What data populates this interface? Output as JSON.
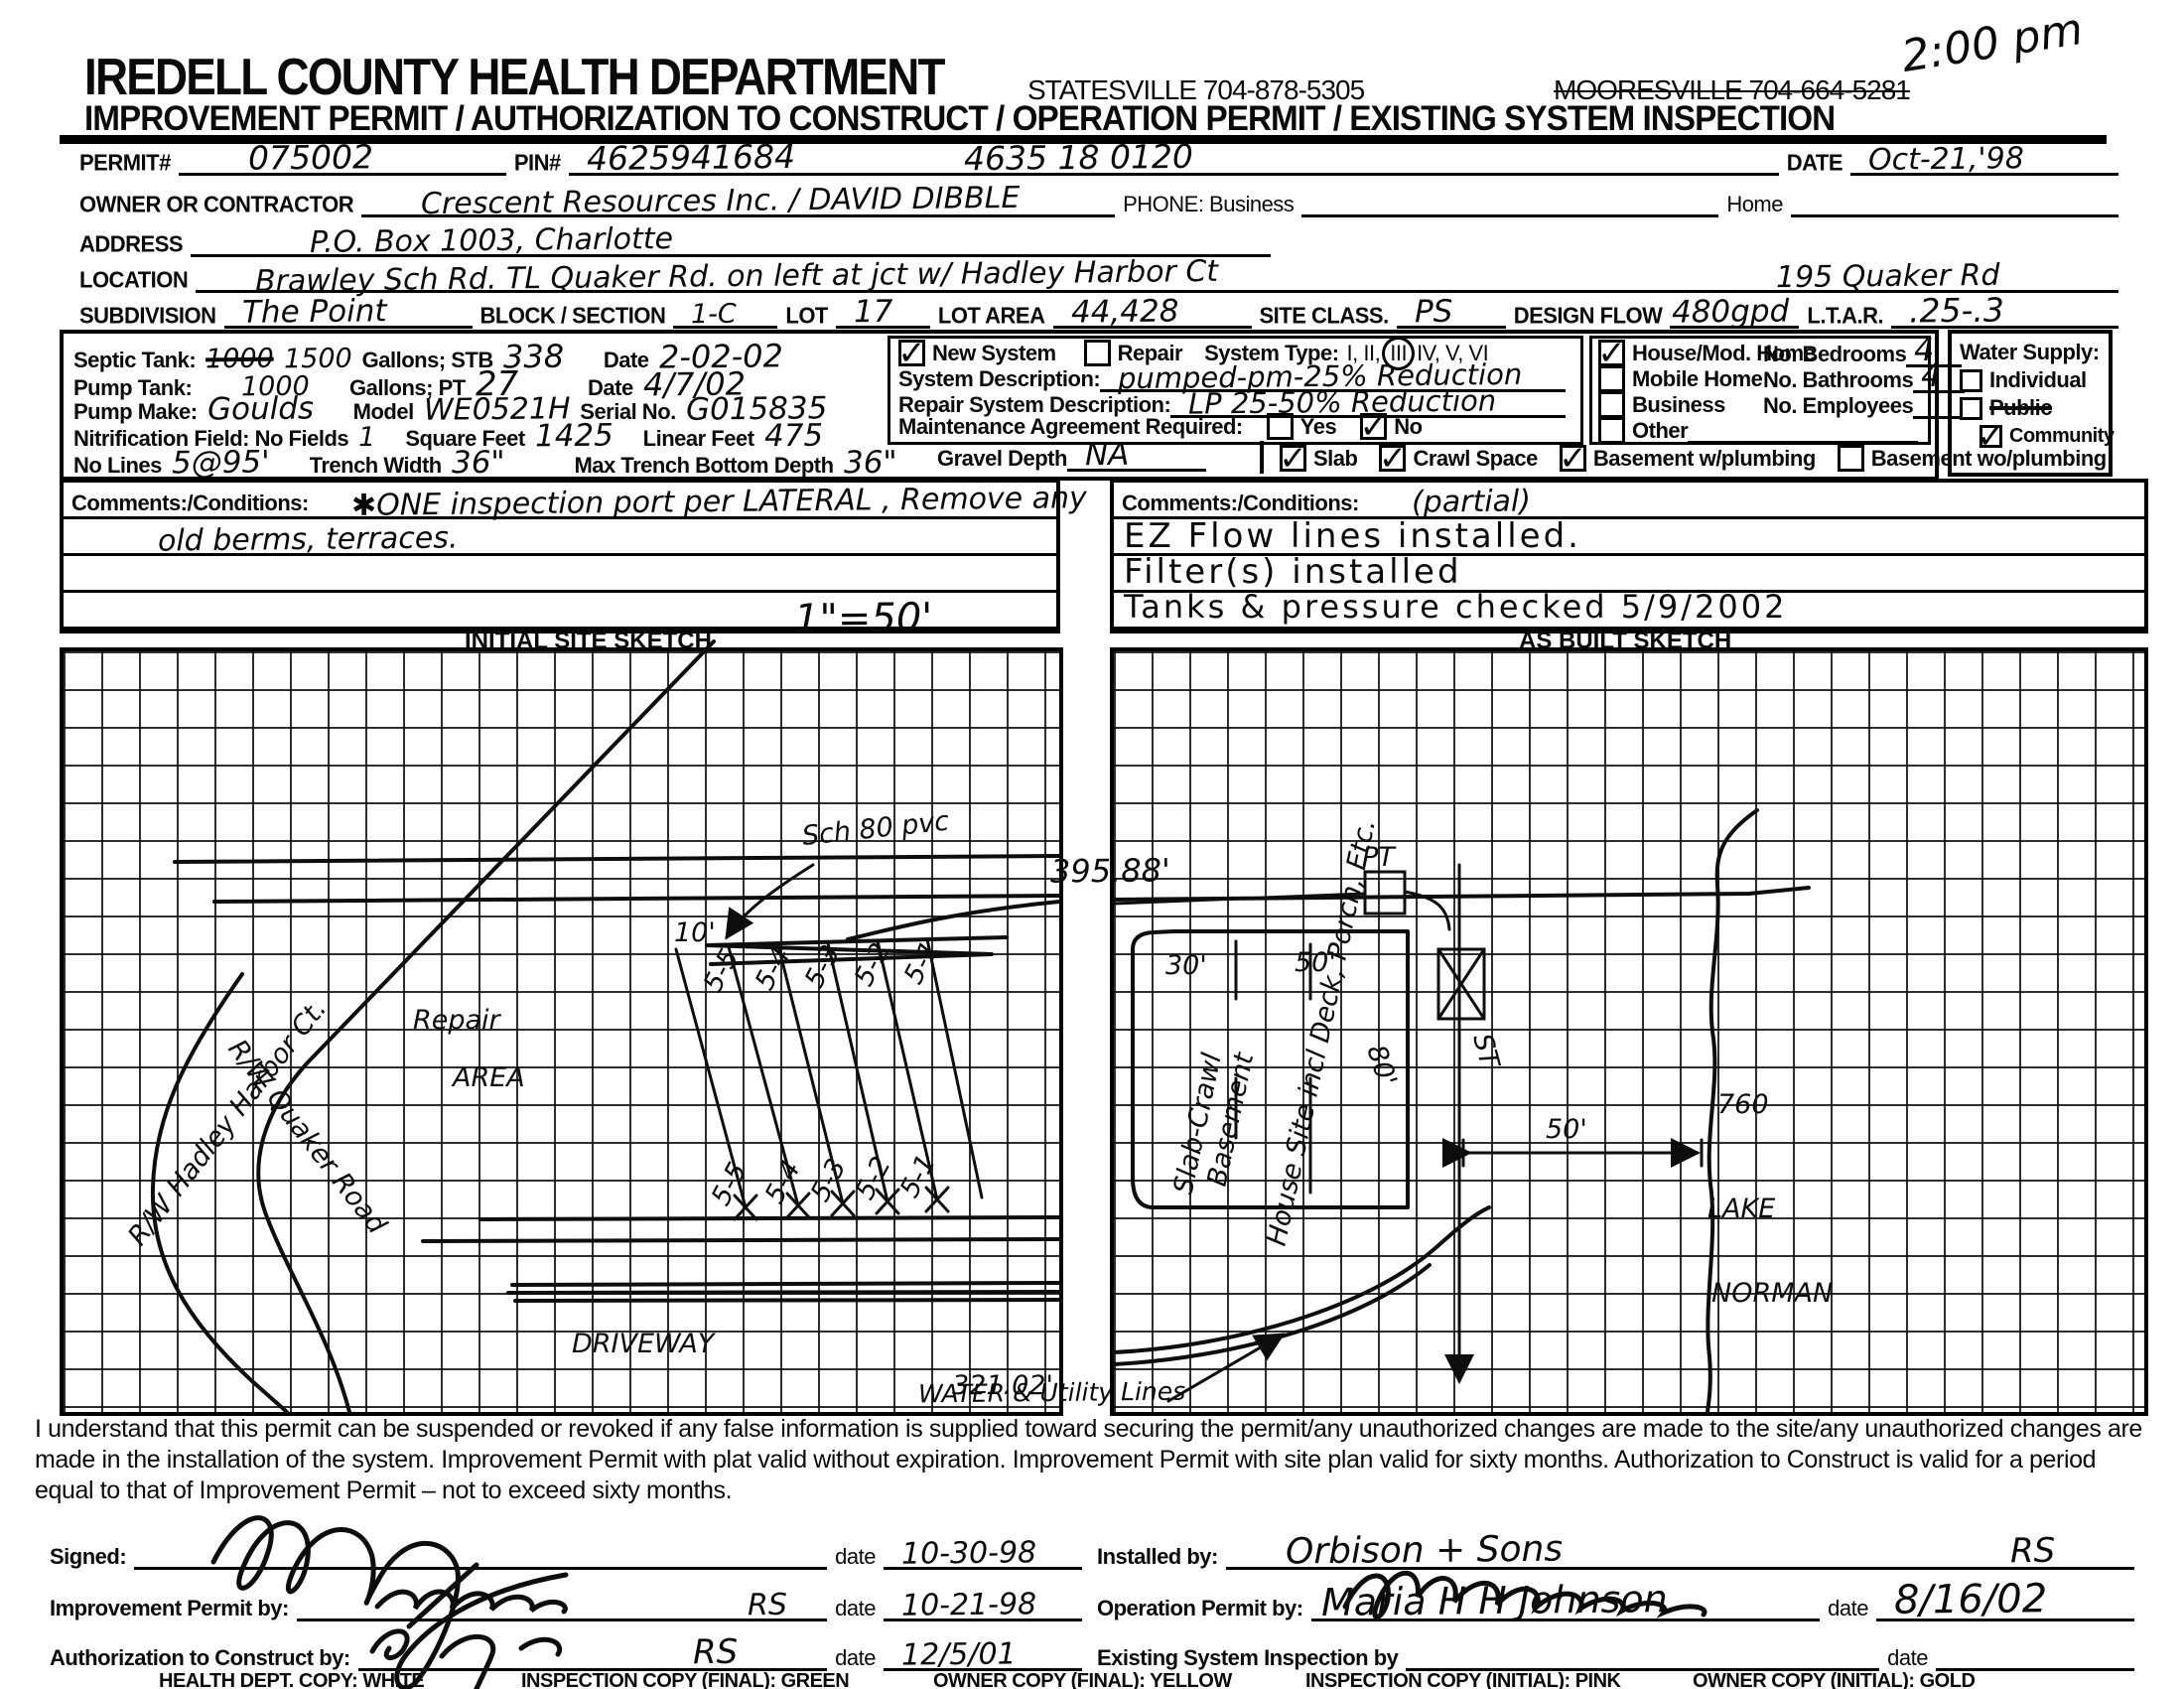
{
  "icons": {
    "check": "✓"
  },
  "header": {
    "department": "IREDELL COUNTY HEALTH DEPARTMENT",
    "statesville": "STATESVILLE 704-878-5305",
    "mooresville": "MOORESVILLE 704-664-5281",
    "time_note": "2:00 pm",
    "subtitle": "IMPROVEMENT PERMIT / AUTHORIZATION TO CONSTRUCT / OPERATION PERMIT / EXISTING SYSTEM INSPECTION"
  },
  "fields": {
    "permit_label": "PERMIT#",
    "permit_value": "075002",
    "pin_label": "PIN#",
    "pin_value": "4625941684",
    "parcel_value": "4635  18  0120",
    "date_label": "DATE",
    "date_value": "Oct-21,'98",
    "owner_label": "OWNER OR CONTRACTOR",
    "owner_value": "Crescent Resources Inc. / DAVID DIBBLE",
    "phone_label": "PHONE: Business",
    "home_label": "Home",
    "address_label": "ADDRESS",
    "address_value": "P.O. Box 1003, Charlotte",
    "location_label": "LOCATION",
    "location_value": "Brawley Sch Rd.   TL Quaker Rd.   on left at jct w/ Hadley Harbor Ct",
    "location_value2": "195 Quaker Rd",
    "subdivision_label": "SUBDIVISION",
    "subdivision_value": "The Point",
    "block_label": "BLOCK / SECTION",
    "block_value": "1-C",
    "lot_label": "LOT",
    "lot_value": "17",
    "lot_area_label": "LOT AREA",
    "lot_area_value": "44,428",
    "site_class_label": "SITE CLASS.",
    "site_class_value": "PS",
    "design_flow_label": "DESIGN FLOW",
    "design_flow_value": "480gpd",
    "ltar_label": "L.T.A.R.",
    "ltar_value": ".25-.3"
  },
  "tank": {
    "septic_label": "Septic Tank:",
    "septic_old": "1000",
    "septic_new": "1500",
    "septic_units": "Gallons;  STB",
    "stb_value": "338",
    "date_label": "Date",
    "stb_date": "2-02-02",
    "pump_label": "Pump Tank:",
    "pump_value": "1000",
    "pump_units": "Gallons;  PT",
    "pt_value": "27",
    "pt_date": "4/7/02",
    "make_label": "Pump Make:",
    "make_value": "Goulds",
    "model_label": "Model",
    "model_value": "WE0521H",
    "serial_label": "Serial No.",
    "serial_value": "G015835",
    "nit_label": "Nitrification Field: No Fields",
    "fields_value": "1",
    "sqft_label": "Square Feet",
    "sqft_value": "1425",
    "linear_label": "Linear Feet",
    "linear_value": "475",
    "lines_label": "No Lines",
    "lines_value": "5@95'",
    "trench_label": "Trench Width",
    "trench_value": "36\"",
    "depth_label": "Max Trench Bottom Depth",
    "depth_value": "36\""
  },
  "system": {
    "new_label": "New System",
    "repair_label": "Repair",
    "type_label": "System Type:",
    "type_pre": "I, II,",
    "type_circled": "III",
    "type_post": "IV, V, VI",
    "new_checked": true,
    "repair_checked": false,
    "desc_label": "System Description:",
    "desc_value": "pumped-pm-25% Reduction",
    "repair_desc_label": "Repair System Description:",
    "repair_desc_value": "LP 25-50% Reduction",
    "maint_label": "Maintenance Agreement Required:",
    "yes_label": "Yes",
    "no_label": "No",
    "yes_checked": false,
    "no_checked": true,
    "gravel_label": "Gravel Depth",
    "gravel_value": "NA",
    "slab_label": "Slab",
    "crawl_label": "Crawl Space",
    "bw_label": "Basement w/plumbing",
    "bwo_label": "Basement wo/plumbing",
    "slab_checked": true,
    "crawl_checked": true,
    "bw_checked": true,
    "bwo_checked": false
  },
  "structure": {
    "house_label": "House/Mod. Home",
    "mobile_label": "Mobile Home",
    "business_label": "Business",
    "other_label": "Other",
    "house_checked": true,
    "mobile_checked": false,
    "business_checked": false,
    "other_checked": false,
    "bedrooms_label": "No. Bedrooms",
    "bedrooms_value": "4",
    "bathrooms_label": "No. Bathrooms",
    "bathrooms_value": "4",
    "employees_label": "No. Employees",
    "employees_value": ""
  },
  "water": {
    "title": "Water Supply:",
    "individual": "Individual",
    "public": "Public",
    "community": "Community",
    "individual_checked": false,
    "public_checked": false,
    "community_checked": true
  },
  "comments_left": {
    "label": "Comments:/Conditions:",
    "line1": "✱ONE inspection port per LATERAL , Remove any",
    "line2": "old berms, terraces."
  },
  "comments_right": {
    "label": "Comments:/Conditions:",
    "note": "(partial)",
    "line1": "EZ Flow lines installed.",
    "line2": "Filter(s) installed",
    "line3": "Tanks & pressure checked 5/9/2002"
  },
  "sketch": {
    "left_title": "INITIAL SITE SKETCH",
    "scale_note": "1\"=50'",
    "right_title": "AS BUILT SKETCH",
    "left": {
      "road1": "R/W Hadley Harbor Ct.",
      "road2": "R/W Quaker Road",
      "repair1": "Repair",
      "repair2": "AREA",
      "pipe": "Sch 80 pvc",
      "ten": "10'",
      "boundary": "395.88'",
      "driveway": "DRIVEWAY",
      "front": "321.02'",
      "lat_top": [
        "5-5",
        "5-4",
        "5-3",
        "5-2",
        "5-1"
      ],
      "lat_bot": [
        "5-5",
        "5-4",
        "5-3",
        "5-2",
        "5-1"
      ]
    },
    "right": {
      "pt": "PT",
      "st": "ST",
      "w30": "30'",
      "w50": "50'",
      "d80": "80'",
      "basement": "Basement",
      "slab": "Slab-Crawl",
      "house": "House Site incl Deck, Porch, Etc.",
      "dist50": "50'",
      "contour": "760",
      "lake1": "LAKE",
      "lake2": "NORMAN",
      "utilities": "WATER & Utility Lines"
    }
  },
  "legal": "I understand that this permit can be suspended or revoked if any false information is supplied toward securing the permit/any unauthorized changes are made to the site/any unauthorized changes are made in the installation of the system. Improvement Permit with plat valid without expiration. Improvement Permit with site plan valid for sixty months. Authorization to Construct is valid for a period equal to that of Improvement Permit – not to exceed sixty months.",
  "signatures": {
    "signed_label": "Signed:",
    "date_label": "date",
    "signed_date": "10-30-98",
    "improvement_label": "Improvement Permit by:",
    "improvement_suffix": "RS",
    "improvement_date": "10-21-98",
    "authorization_label": "Authorization to Construct by:",
    "authorization_suffix": "RS",
    "authorization_date": "12/5/01",
    "installed_label": "Installed by:",
    "installed_value": "Orbison + Sons",
    "installed_suffix": "RS",
    "operation_label": "Operation Permit by:",
    "operation_value": "Maria H H Johnson",
    "operation_date": "8/16/02",
    "existing_label": "Existing System Inspection by",
    "existing_date": ""
  },
  "footer": {
    "c1": "HEALTH DEPT. COPY: WHITE",
    "c2": "INSPECTION COPY (FINAL): GREEN",
    "c3": "OWNER COPY (FINAL): YELLOW",
    "c4": "INSPECTION COPY (INITIAL): PINK",
    "c5": "OWNER COPY (INITIAL): GOLD"
  }
}
